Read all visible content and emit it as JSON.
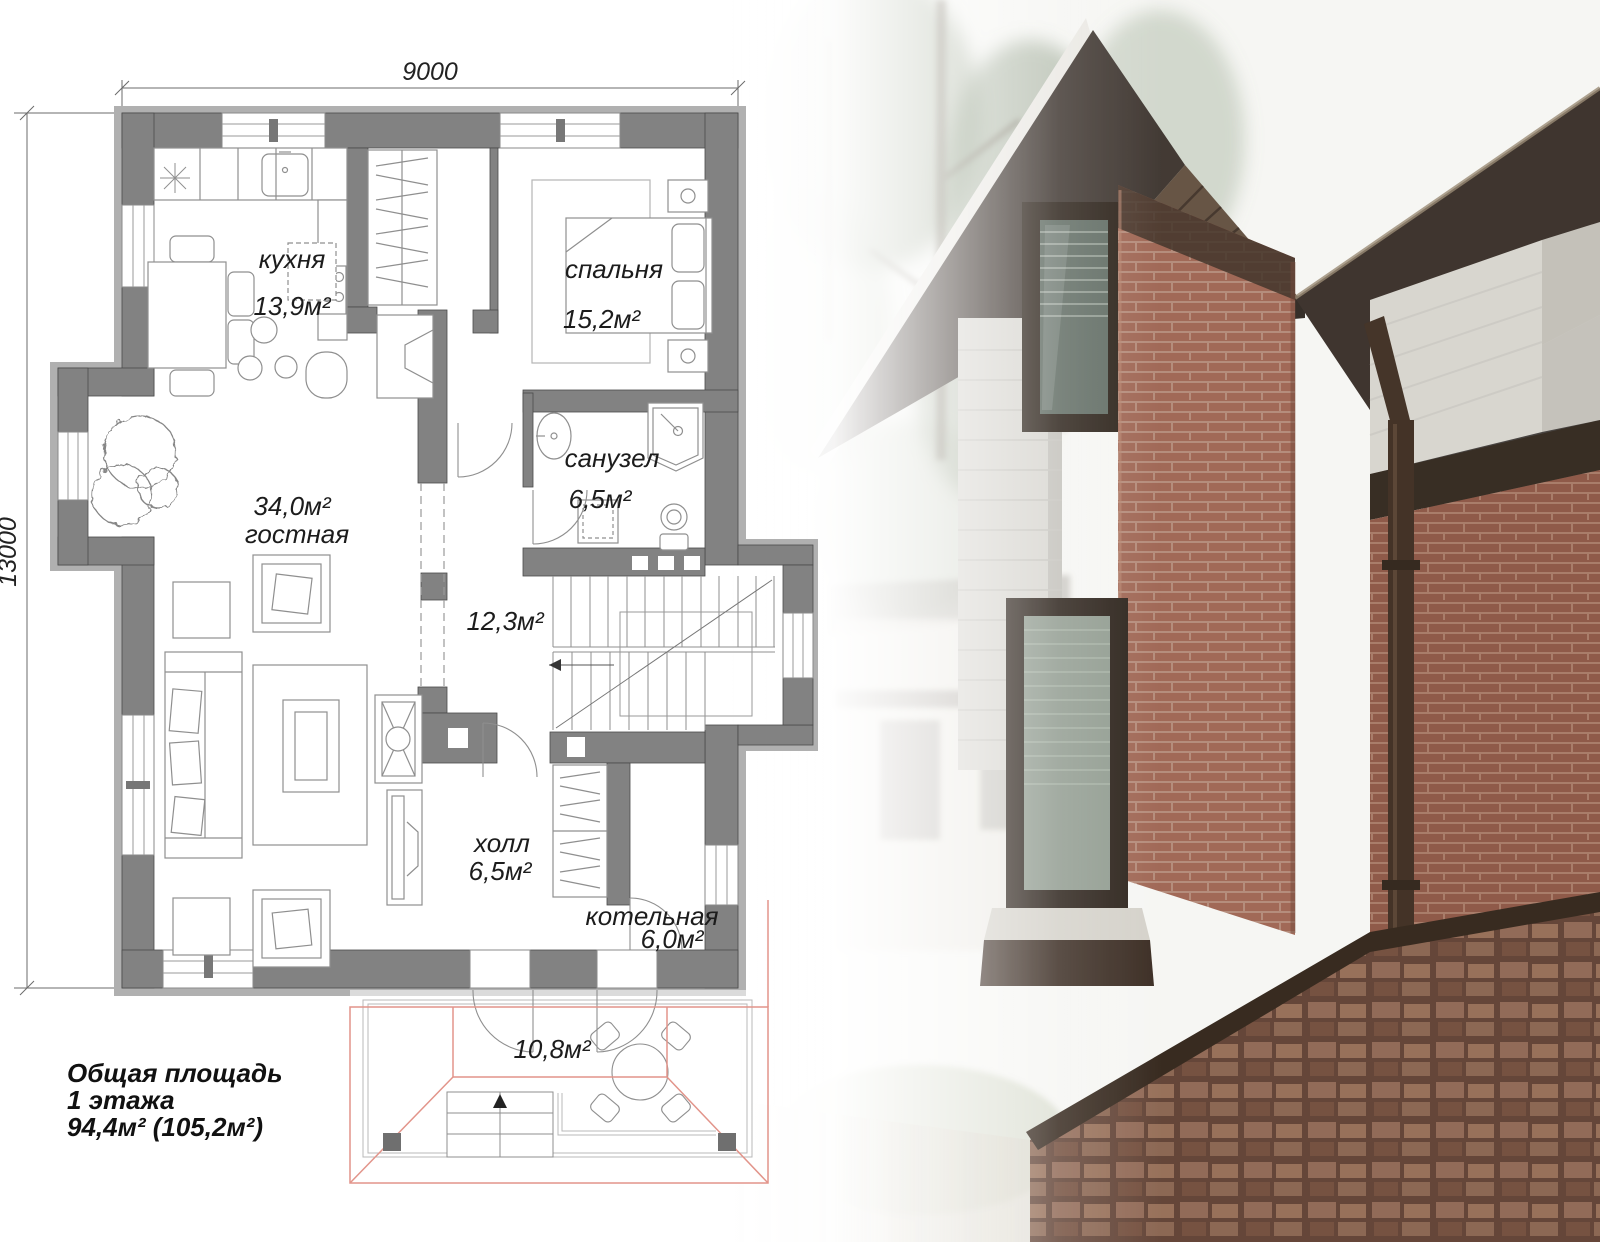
{
  "plan": {
    "dim_width": "9000",
    "dim_height": "13000",
    "rooms": {
      "kitchen": {
        "name": "кухня",
        "area": "13,9м²"
      },
      "bedroom": {
        "name": "спальня",
        "area": "15,2м²"
      },
      "bathroom": {
        "name": "санузел",
        "area": "6,5м²"
      },
      "stairs": {
        "area": "12,3м²"
      },
      "living": {
        "area": "34,0м²",
        "name": "гостная"
      },
      "hall": {
        "name": "холл",
        "area": "6,5м²"
      },
      "boiler": {
        "name": "котельная",
        "area": "6,0м²"
      },
      "terrace": {
        "area": "10,8м²"
      }
    },
    "summary": {
      "line1": "Общая площадь",
      "line2": "1 этажа",
      "line3": "94,4м² (105,2м²)"
    }
  },
  "colors": {
    "wall_gray": "#828282",
    "wall_band": "#b0b0b0",
    "line_gray": "#8f8f8f",
    "roof_outline_red": "#e2948a",
    "brick": "#9c614e",
    "roof_dark": "#352b24",
    "stone_white": "#d7d5cf"
  }
}
